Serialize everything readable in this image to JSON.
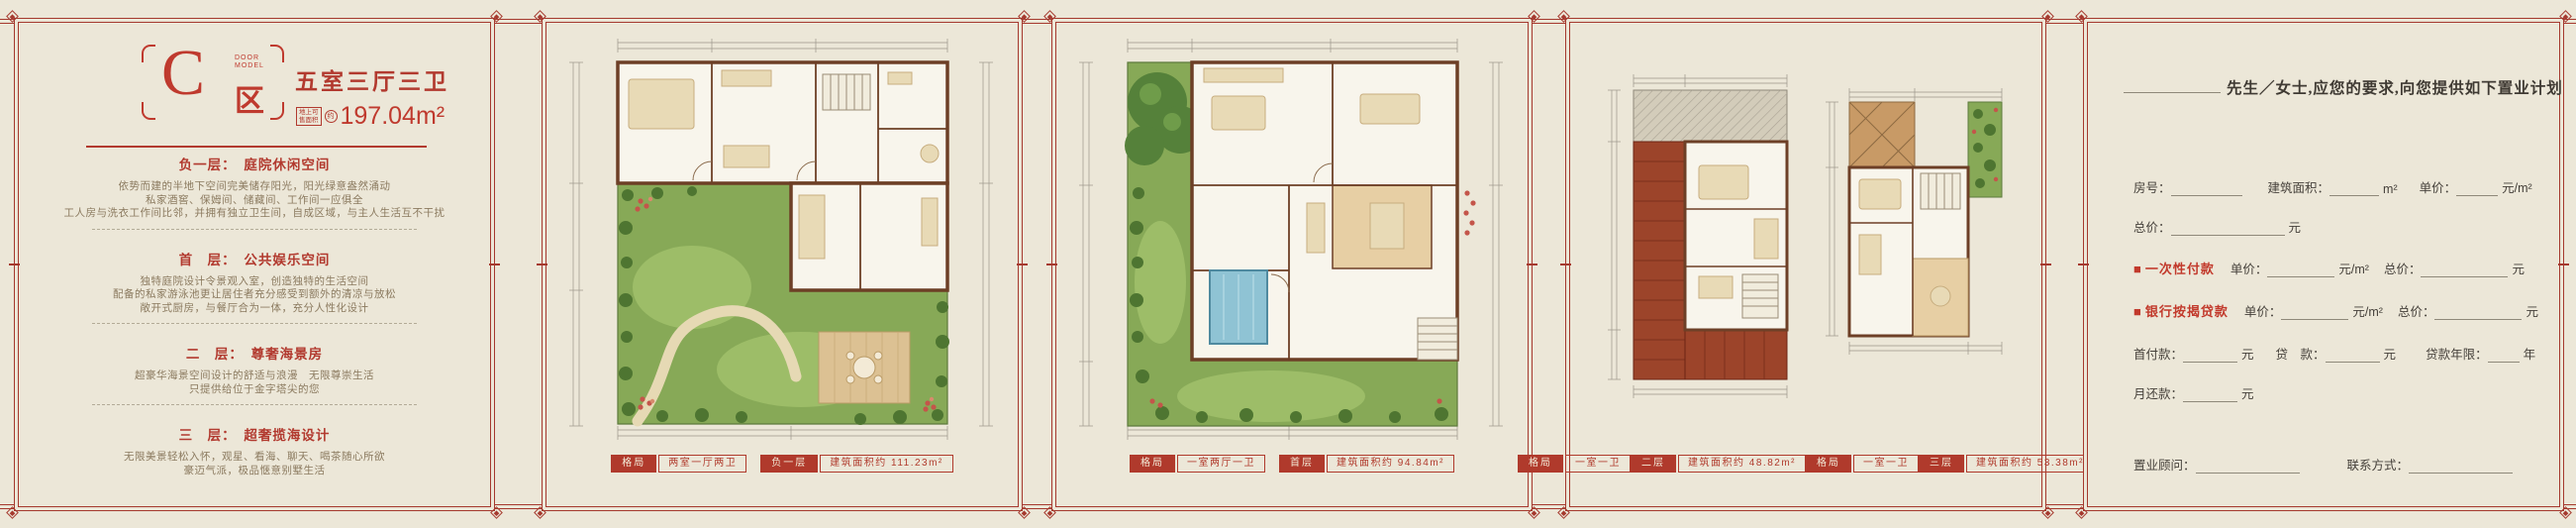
{
  "colors": {
    "background": "#ece7d8",
    "frame_red": "#a5392e",
    "accent_red": "#bf3a2e",
    "body_text": "#8b7a5f",
    "form_text": "#45403a",
    "garden_green": "#87a957",
    "roof_red": "#9c442a"
  },
  "panel_c": {
    "logo": {
      "letter": "C",
      "sub1": "DOOR",
      "sub2": "MODEL",
      "zone": "区"
    },
    "title": "五室三厅三卫",
    "area": {
      "tag1": "地上可",
      "tag2": "售面积",
      "approx": "约",
      "value": "197.04m²"
    },
    "sections": [
      {
        "heading": "负一层：　庭院休闲空间",
        "lines": [
          "依势而建的半地下空间完美储存阳光，阳光绿意盎然涌动",
          "私家酒窖、保姆间、储藏间、工作间一应俱全",
          "工人房与洗衣工作间比邻，并拥有独立卫生间，自成区域，与主人生活互不干扰"
        ]
      },
      {
        "heading": "首　层：　公共娱乐空间",
        "lines": [
          "独特庭院设计令景观入室，创造独特的生活空间",
          "配备的私家游泳池更让居住者充分感受到额外的清凉与放松",
          "敞开式厨房，与餐厅合为一体，充分人性化设计"
        ]
      },
      {
        "heading": "二　层：　尊奢海景房",
        "lines": [
          "超豪华海景空间设计的舒适与浪漫　无限尊崇生活",
          "只提供给位于金字塔尖的您"
        ]
      },
      {
        "heading": "三　层：　超奢揽海设计",
        "lines": [
          "无限美景轻松入怀，观星、看海、聊天、喝茶随心所欲",
          "豪迈气派，极品惬意别墅生活"
        ]
      }
    ]
  },
  "plans": [
    {
      "badges": [
        {
          "k": "格局",
          "v": "两室一厅两卫"
        },
        {
          "k": "负一层",
          "v": "建筑面积约 111.23m²"
        }
      ]
    },
    {
      "badges": [
        {
          "k": "格局",
          "v": "一室两厅一卫"
        },
        {
          "k": "首层",
          "v": "建筑面积约 94.84m²"
        }
      ]
    },
    {
      "badges": [
        {
          "k": "格局",
          "v": "一室一卫"
        },
        {
          "k": "二层",
          "v": "建筑面积约 48.82m²"
        }
      ]
    },
    {
      "badges": [
        {
          "k": "格局",
          "v": "一室一卫"
        },
        {
          "k": "三层",
          "v": "建筑面积约 53.38m²"
        }
      ]
    }
  ],
  "form": {
    "title": "先生／女士,应您的要求,向您提供如下置业计划",
    "labels": {
      "room_no": "房号：",
      "build_area": "建筑面积：",
      "sqm": "m²",
      "unit_price": "单价：",
      "yuan_sqm": "元/m²",
      "total_price": "总价：",
      "yuan": "元",
      "bullet": "■",
      "one_time": "一次性付款",
      "mortgage": "银行按揭贷款",
      "down_payment": "首付款：",
      "loan": "贷　款：",
      "loan_term": "贷款年限：",
      "year": "年",
      "monthly": "月还款：",
      "consultant": "置业顾问：",
      "contact": "联系方式："
    }
  }
}
